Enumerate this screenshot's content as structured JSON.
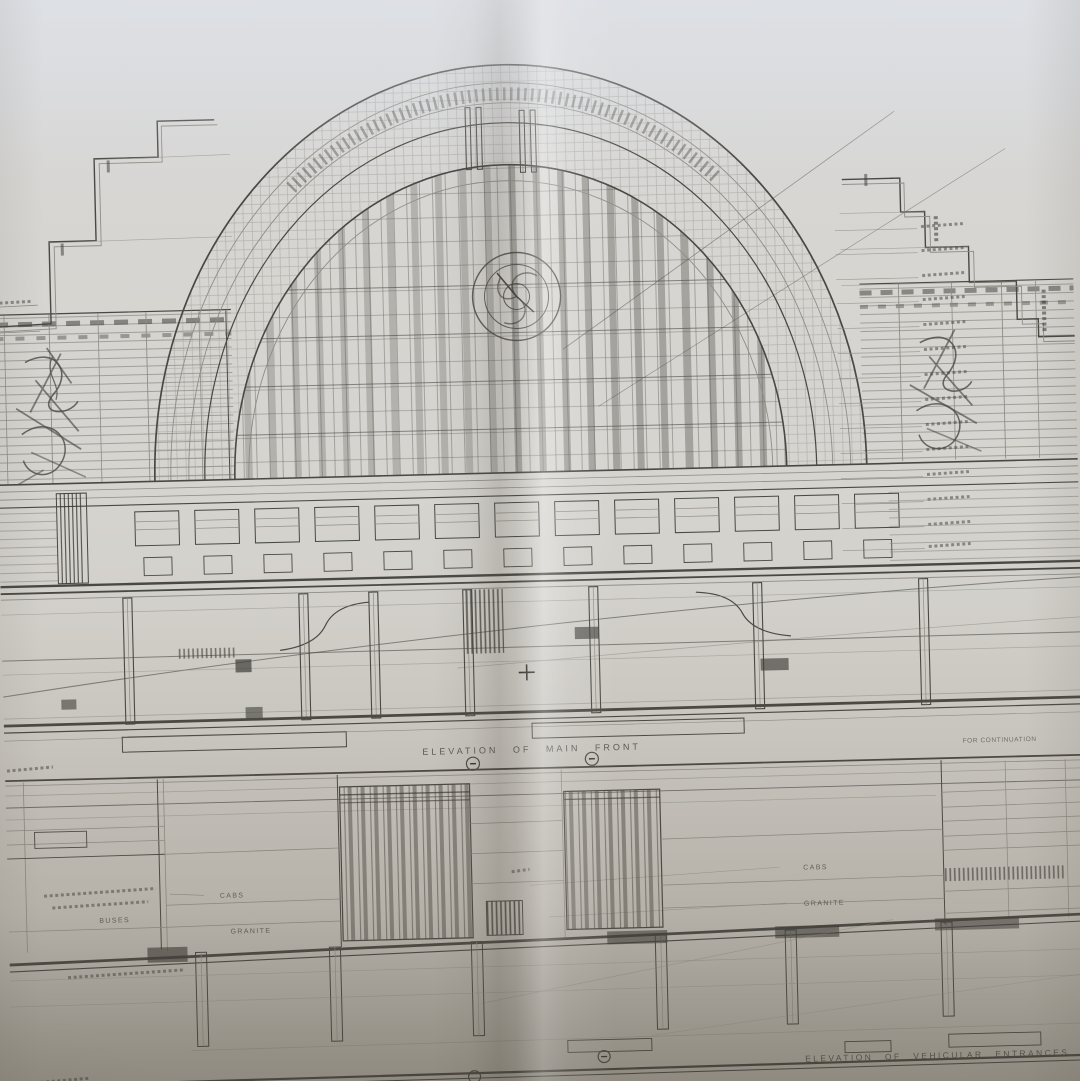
{
  "palette": {
    "paper": "#d6d4cf",
    "paper_top": "#d8dade",
    "paper_shadow": "#b0aca2",
    "ink": "#4a4843",
    "ink_faint": "#908d85",
    "ink_dark": "#35332f"
  },
  "sheet": {
    "upper_elevation": {
      "caption": "ELEVATION OF MAIN FRONT",
      "continuation_note": "FOR CONTINUATION"
    },
    "lower_elevation": {
      "caption": "ELEVATION OF VEHICULAR ENTRANCES",
      "wall_labels": {
        "left_cabs": "CABS",
        "left_granite": "GRANITE",
        "buses": "BUSES",
        "right_cabs": "CABS",
        "right_granite": "GRANITE"
      }
    }
  }
}
